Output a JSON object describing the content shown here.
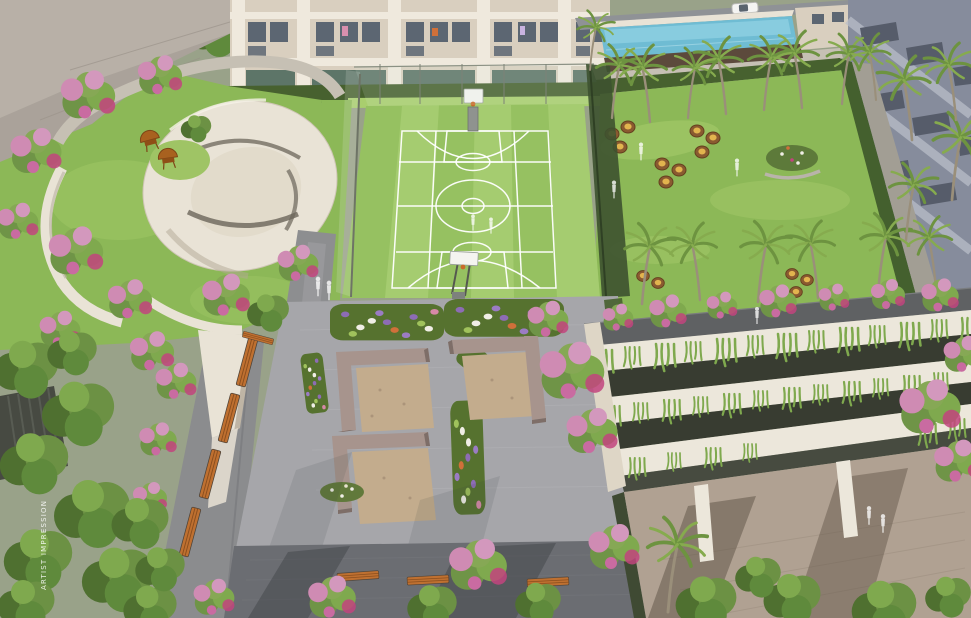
{
  "watermark": {
    "text": "ARTIST IMPRESSION"
  },
  "palette": {
    "base_green": "#99a289",
    "lawn_green": "#8cb857",
    "lawn_light": "#a9ce6e",
    "court_green": "#96c161",
    "court_stripe": "#a5cc70",
    "line_white": "#ffffff",
    "hedge_dark": "#47612f",
    "foliage_dark": "#4f7030",
    "foliage_mid": "#5f8a3c",
    "foliage_light": "#7fa94e",
    "palm_green": "#6d9340",
    "palm_light": "#86ab4e",
    "trunk_grey": "#9a8f7a",
    "blossom_pink": "#cf8bb3",
    "blossom_light": "#d398bd",
    "blossom_deep": "#c2447e",
    "wall_cream": "#e9e3d6",
    "wall_shade": "#bfb5a5",
    "facade_cream": "#d9cfbf",
    "facade_white": "#efe9dd",
    "window_dark": "#5c6672",
    "glass_green": "#5d7568",
    "road_grey": "#8f9296",
    "path_grey": "#8d8e90",
    "path_light": "#c6c0b4",
    "paver_light": "#a6a6aa",
    "plaza_dark": "#6b6d72",
    "paver_tan": "#b0a192",
    "paver_line": "#9b8d7e",
    "seat_taupe": "#a7948d",
    "seat_shade": "#7e6e68",
    "gravel_tan": "#c3ac8d",
    "bed_green": "#56722f",
    "slot_dark": "#383c31",
    "band_cream": "#ece7db",
    "pool_blue": "#6fbcd3",
    "planter_brown": "#5c4a3c",
    "bldg_bluegrey": "#868c9c",
    "bldg_slot": "#565c6a",
    "creeper_green": "#7fa94e",
    "flower_purple": "#8d6cb5",
    "flower_orange": "#d0703a",
    "flower_white": "#f0eee6",
    "pod_wicker": "#8a5a30",
    "pod_cushion": "#e2b44e",
    "bench_wood": "#bf7030",
    "bench_dark": "#8a4e1e",
    "chair_wood": "#a8611f",
    "pergola_dark": "#474a42",
    "shadow_dark": "#3c3e42"
  }
}
